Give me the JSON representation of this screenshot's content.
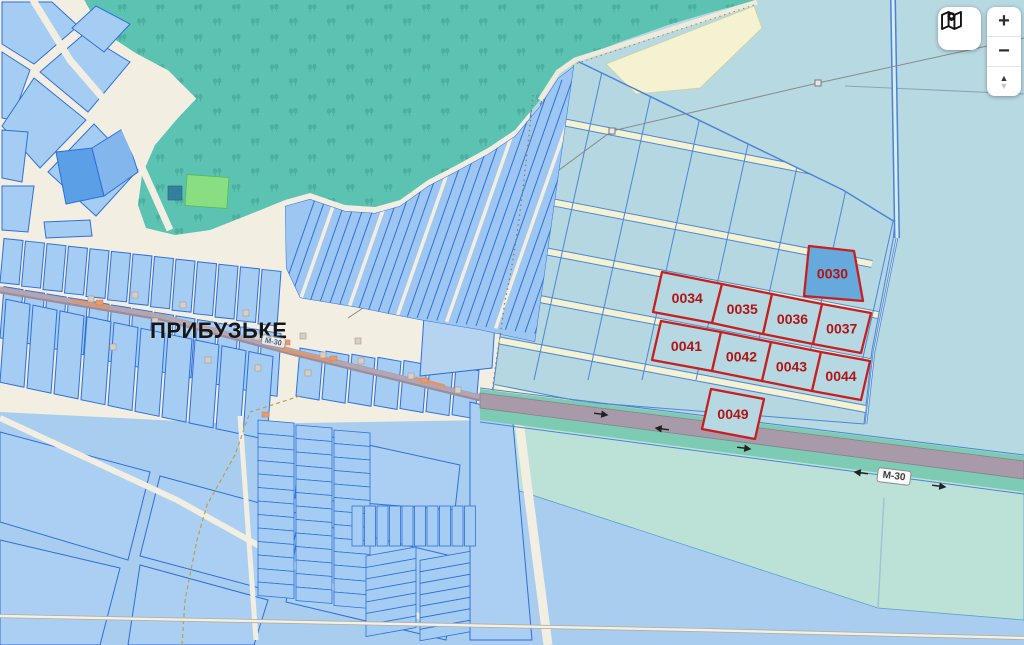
{
  "map": {
    "place_label": "ПРИБУЗЬКЕ",
    "road_shield_label": "М-30",
    "highlighted_parcels": [
      {
        "label": "0030",
        "fill": "#66a9dd"
      },
      {
        "label": "0034",
        "fill": "#b5d8e2"
      },
      {
        "label": "0035",
        "fill": "#b5d8e2"
      },
      {
        "label": "0036",
        "fill": "#b5d8e2"
      },
      {
        "label": "0037",
        "fill": "#b5d8e2"
      },
      {
        "label": "0041",
        "fill": "#b5d8e2"
      },
      {
        "label": "0042",
        "fill": "#b5d8e2"
      },
      {
        "label": "0043",
        "fill": "#b5d8e2"
      },
      {
        "label": "0044",
        "fill": "#b5d8e2"
      },
      {
        "label": "0049",
        "fill": "#b5d8e2"
      }
    ],
    "colors": {
      "parcel_outline": "#c61f1f",
      "parcel_label": "#b01414",
      "water_background": "#b7d9e2",
      "lower_background": "#a9cdee",
      "village_background": "#f2eee2",
      "village_parcel": "#a5cdf3",
      "village_parcel_border": "#2e6fdd",
      "field_parcel": "#b4d7e1",
      "field_border": "#4d85d8",
      "forest": "#5cc3b2",
      "field_road": "#f4f2d0",
      "highway": "#a89aa8",
      "verge": "#7ecbb4",
      "meadow": "#bce2d7",
      "canal": "#4a82d4"
    }
  },
  "controls": {
    "zoom_in_label": "+",
    "zoom_out_label": "−",
    "tilt_up_glyph": "▲",
    "tilt_down_glyph": "▼"
  }
}
